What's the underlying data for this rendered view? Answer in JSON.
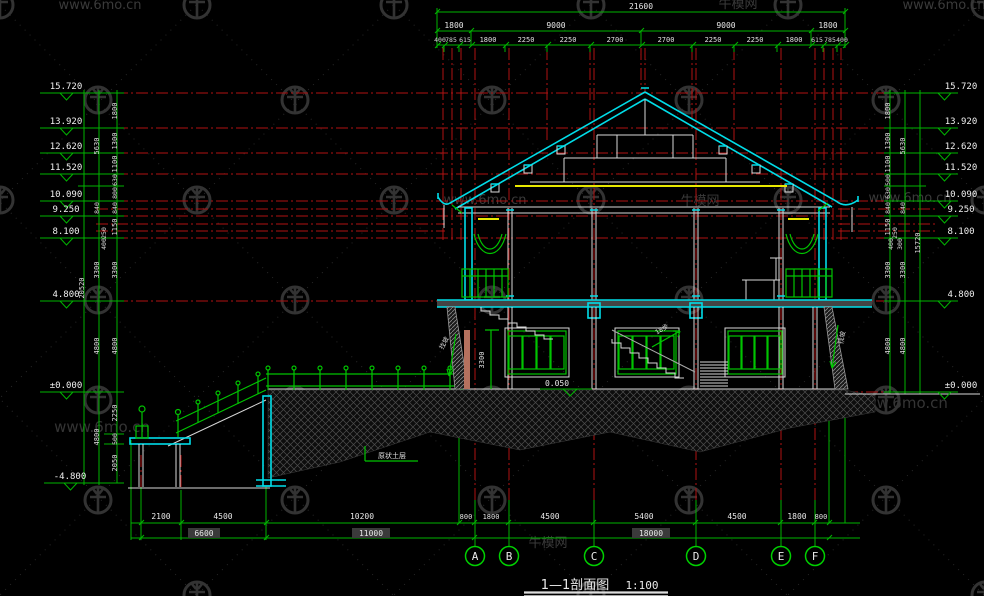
{
  "watermarks": {
    "url": "www.6mo.cn",
    "brand": "牛模网"
  },
  "title": {
    "name": "1—1剖面图",
    "scale": "1:100"
  },
  "grid_bubbles": [
    "A",
    "B",
    "C",
    "D",
    "E",
    "F"
  ],
  "top_dims": {
    "total": "21600",
    "row2": [
      "1800",
      "9000",
      "9000",
      "1800"
    ],
    "r3": [
      "400",
      "785",
      "615",
      "1800",
      "2250",
      "2250",
      "2700",
      "2700",
      "2250",
      "2250",
      "1800",
      "615",
      "785",
      "400"
    ]
  },
  "bottom_dims": {
    "row1": [
      "2100",
      "4500",
      "10200",
      "800",
      "1800",
      "4500",
      "5400",
      "4500",
      "1800",
      "800"
    ],
    "row2": [
      "6600",
      "11000",
      "18000"
    ]
  },
  "levels_left": [
    "15.720",
    "13.920",
    "12.620",
    "11.520",
    "10.090",
    "9.250",
    "8.100",
    "4.800",
    "±0.000",
    "-4.800"
  ],
  "levels_right": [
    "15.720",
    "13.920",
    "12.620",
    "11.520",
    "10.090",
    "9.250",
    "8.100",
    "4.800",
    "±0.000"
  ],
  "left_dims": {
    "inner": [
      "1800",
      "1300",
      "1100",
      "630",
      "800",
      "840",
      "1150",
      "3300",
      "4800",
      "2250",
      "500",
      "2050"
    ],
    "mid": [
      "5630",
      "840",
      "3300",
      "4800",
      "4800"
    ],
    "outer": "20520",
    "small": [
      "250",
      "400"
    ]
  },
  "right_dims": {
    "inner": [
      "1800",
      "1300",
      "1100",
      "500",
      "630",
      "840",
      "1150",
      "3300",
      "4800"
    ],
    "mid": [
      "5630",
      "840",
      "3300",
      "4800"
    ],
    "outer": "15720",
    "small": [
      "250",
      "400",
      "300"
    ]
  },
  "annotations": {
    "floor_level": "0.050",
    "soil_label": "原状土层",
    "stair_label": "18步",
    "ramp_dim": "3300",
    "slope_left": "找坡",
    "slope_right": "找坡"
  }
}
